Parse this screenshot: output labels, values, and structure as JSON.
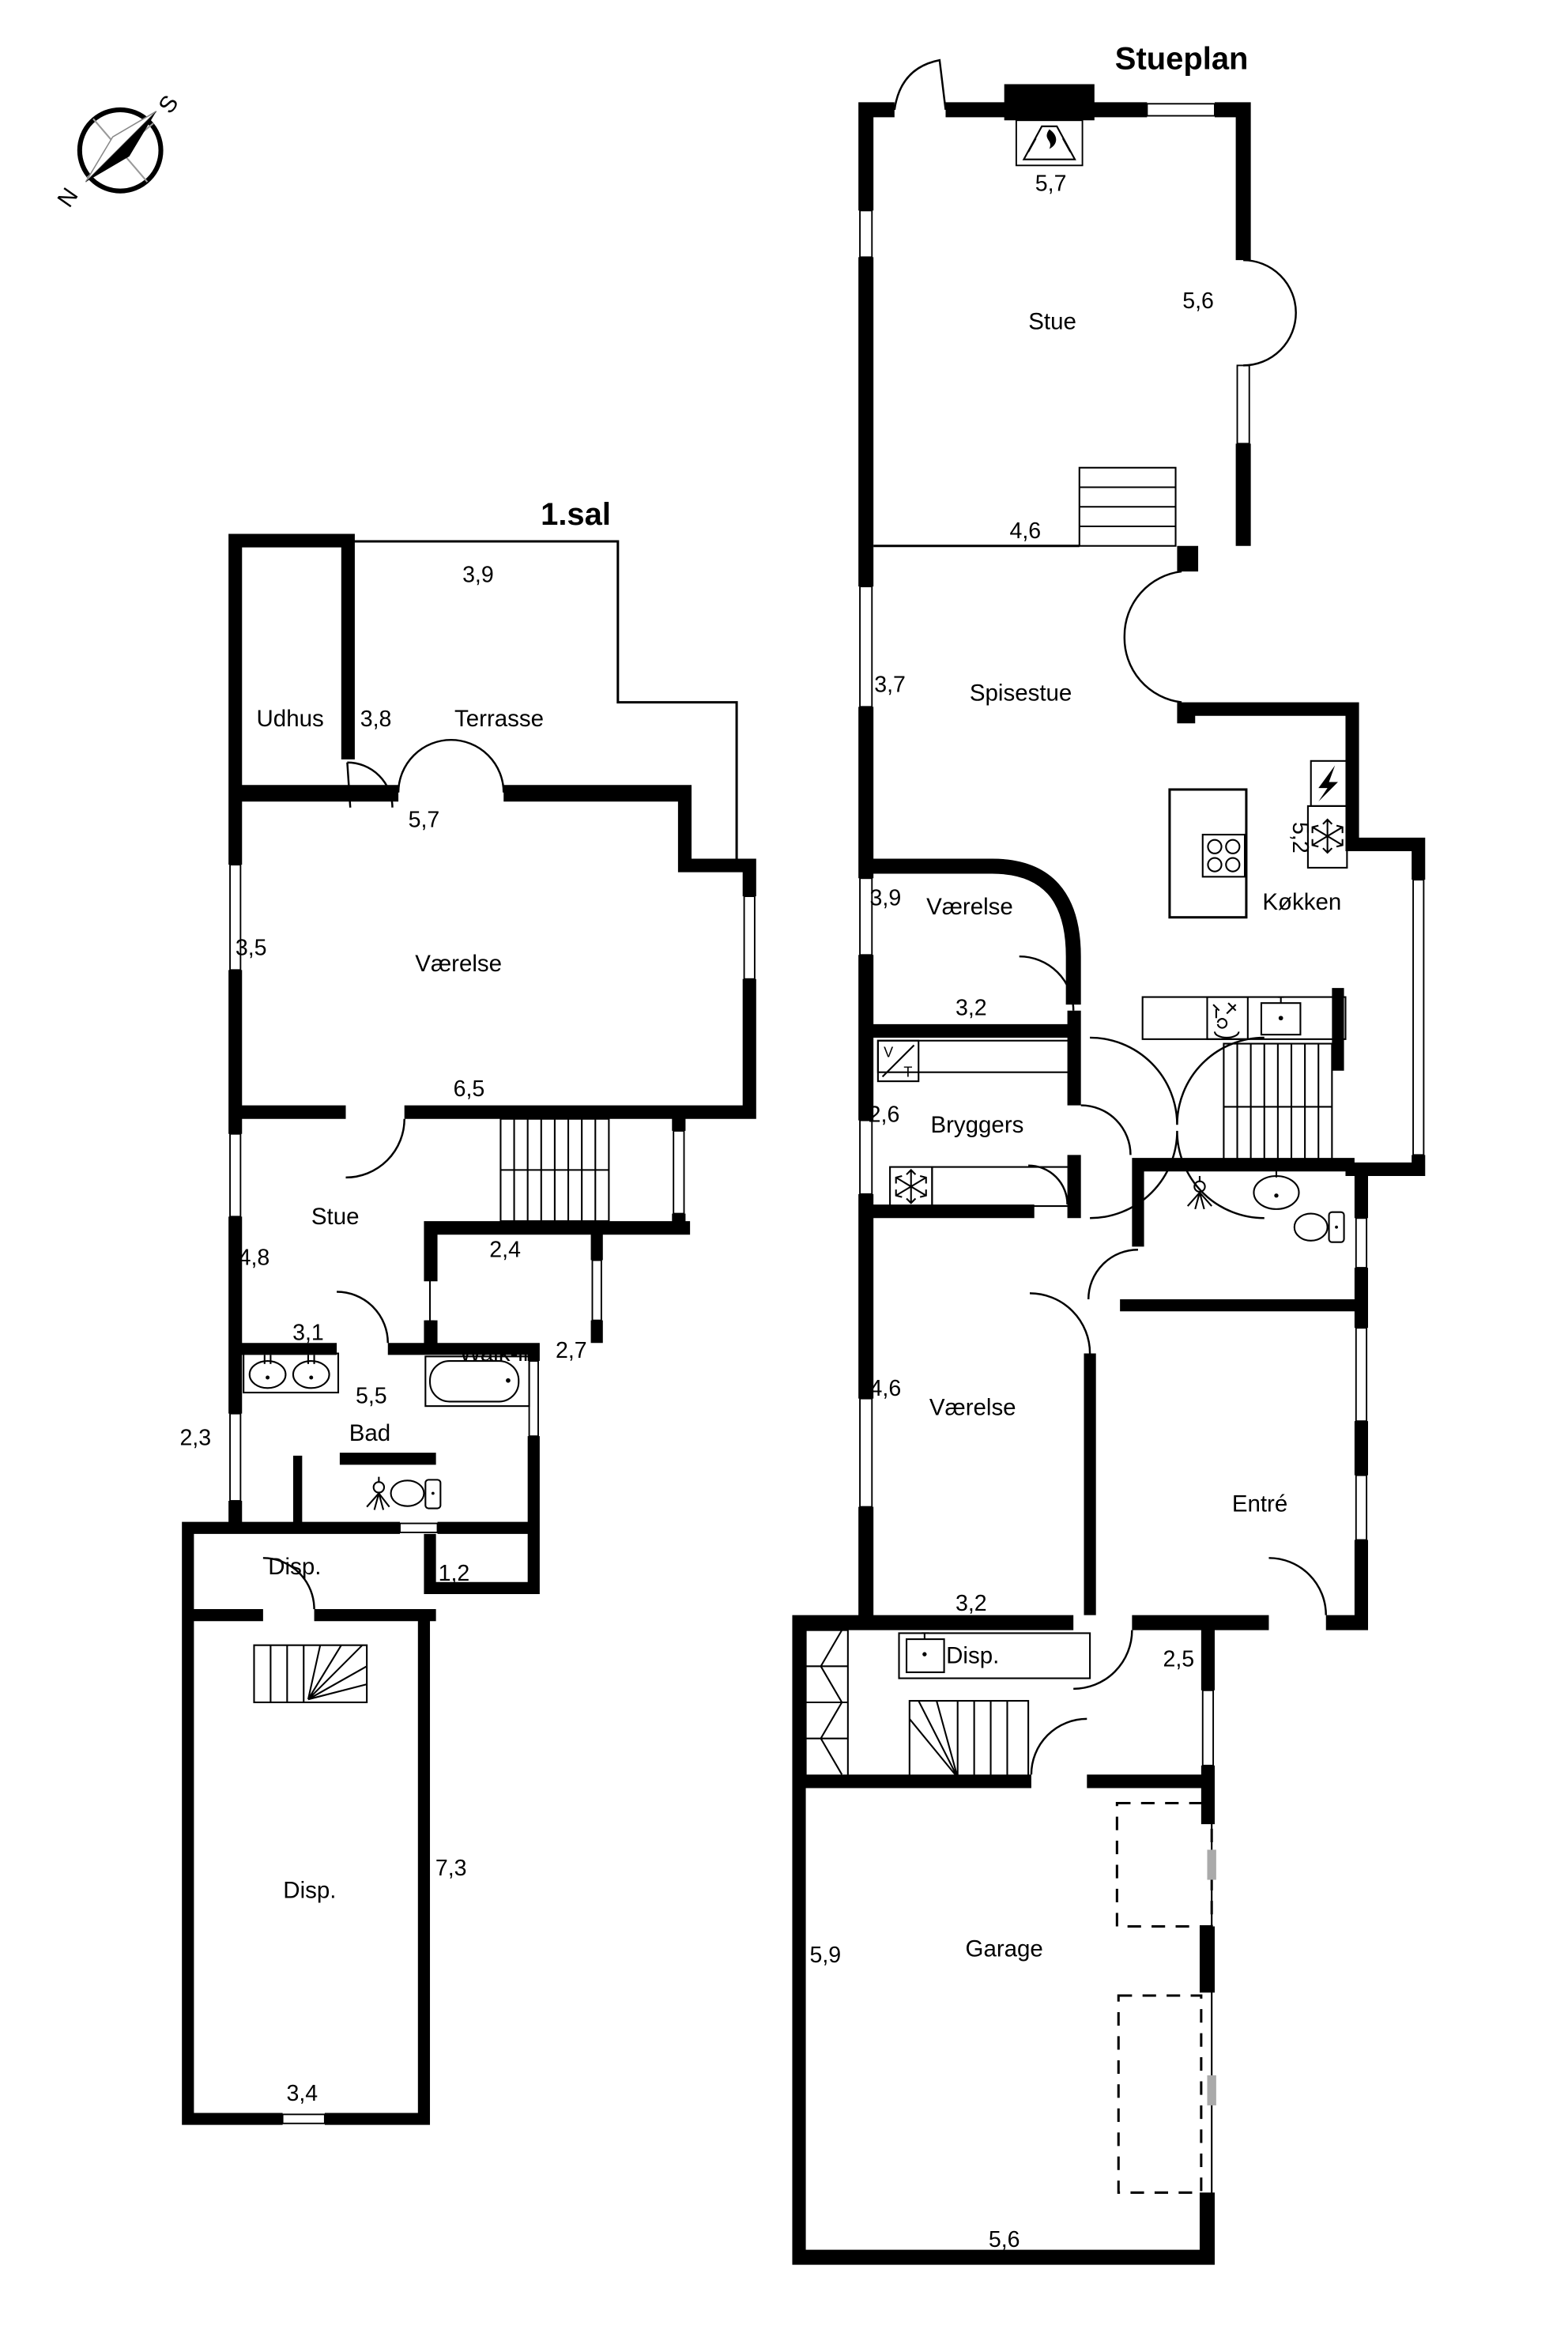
{
  "compass": {
    "north_label": "N",
    "south_label": "S"
  },
  "plans": {
    "first_floor": {
      "title": "1.sal",
      "rooms": {
        "udhus": "Udhus",
        "terrasse": "Terrasse",
        "vaerelse": "Værelse",
        "stue": "Stue",
        "walk_in": "Walk-in",
        "bad": "Bad",
        "disp_upper": "Disp.",
        "disp_lower": "Disp."
      },
      "dims": {
        "d39": "3,9",
        "d38": "3,8",
        "d57": "5,7",
        "d35": "3,5",
        "d65": "6,5",
        "d48": "4,8",
        "d24": "2,4",
        "d27": "2,7",
        "d31": "3,1",
        "d55": "5,5",
        "d23": "2,3",
        "d12": "1,2",
        "d73": "7,3",
        "d34": "3,4"
      }
    },
    "ground_floor": {
      "title": "Stueplan",
      "rooms": {
        "stue": "Stue",
        "spisestue": "Spisestue",
        "vaerelse_north": "Værelse",
        "koekken": "Køkken",
        "bryggers": "Bryggers",
        "vaerelse_south": "Værelse",
        "entre": "Entré",
        "disp": "Disp.",
        "garage": "Garage"
      },
      "dims": {
        "d57": "5,7",
        "d56_top": "5,6",
        "d46_stue": "4,6",
        "d37": "3,7",
        "d39": "3,9",
        "d32_north": "3,2",
        "d52": "5,2",
        "d26": "2,6",
        "d46_south": "4,6",
        "d32_south": "3,2",
        "d25": "2,5",
        "d59": "5,9",
        "d56_bottom": "5,6"
      },
      "appliances": {
        "washer_label": "V",
        "dryer_label": "T"
      }
    }
  },
  "icons": {
    "compass-icon": "circle-with-needle",
    "fireplace-icon": "trapezoid-flame",
    "stove-icon": "four-burner-circles",
    "oven-icon": "lightning-bolt",
    "freezer-icon": "snowflake",
    "dishwasher-icon": "glass-and-cutlery",
    "sink-icon": "basin-with-tap",
    "double-sink-icon": "two-basins-with-taps",
    "bathtub-icon": "rounded-tub",
    "toilet-icon": "bowl-with-tank",
    "shower-icon": "sprinkler-fan",
    "washer-dryer-icon": "V/T-box",
    "wardrobe-icon": "cells-with-zigzag",
    "stairs-icon": "tread-lines",
    "garage-door-icon": "dashed-rectangles"
  }
}
